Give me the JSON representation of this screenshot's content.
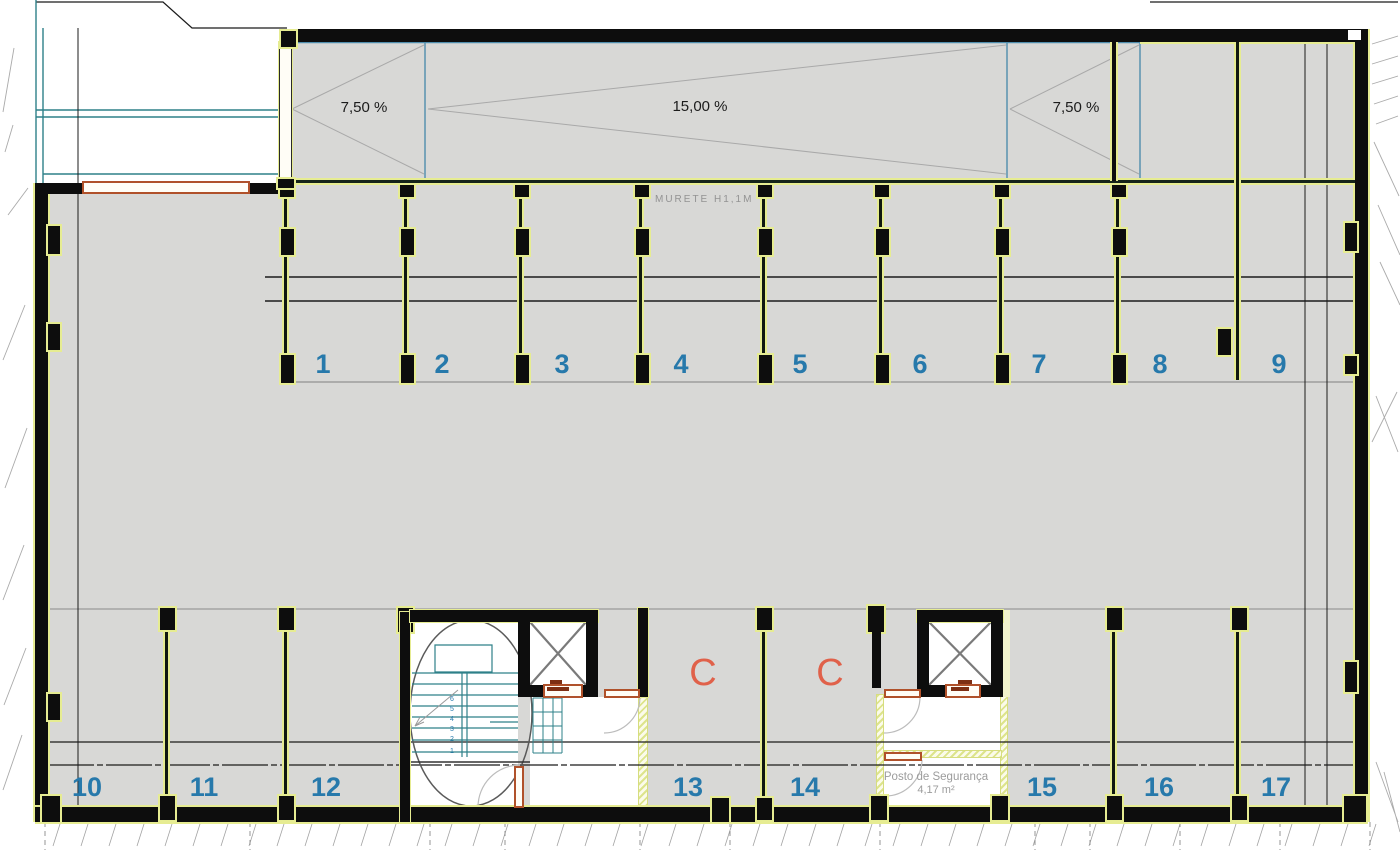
{
  "ramp": {
    "left_slope": "7,50 %",
    "center_slope": "15,00 %",
    "right_slope": "7,50 %"
  },
  "murete_label": "MURETE H1,1M",
  "security_room": {
    "name": "Posto de Segurança",
    "area": "4,17 m²"
  },
  "column_marks": {
    "c1": "C",
    "c2": "C"
  },
  "parking_spaces": {
    "top": [
      "1",
      "2",
      "3",
      "4",
      "5",
      "6",
      "7",
      "8",
      "9"
    ],
    "bottom": [
      "10",
      "11",
      "12",
      "13",
      "14",
      "15",
      "16",
      "17"
    ]
  },
  "stair": {
    "steps": [
      "6",
      "5",
      "4",
      "3",
      "2",
      "1"
    ]
  },
  "colors": {
    "floor_gray": "#d8d8d6",
    "wall_black": "#0d0d0d",
    "halo_yellow": "#e6ec92",
    "space_number_blue": "#2779ab",
    "column_letter_coral": "#e0614a",
    "ramp_outline_blue": "#4f8dad",
    "cad_teal": "#2e8089",
    "door_orange": "#b0512a",
    "label_gray": "#9c9c9c"
  }
}
